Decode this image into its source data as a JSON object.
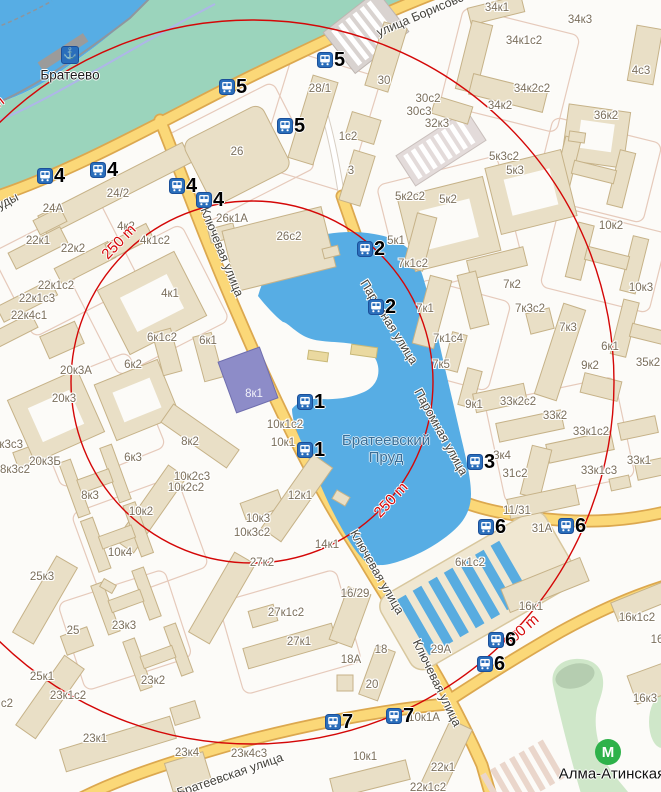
{
  "map": {
    "district_label": "Братеево",
    "pond_label": "Братеевский Пруд",
    "metro": {
      "name": "Алма-Атинская",
      "icon_x": 608,
      "icon_y": 752,
      "label_x": 612,
      "label_y": 774
    },
    "pier": {
      "x": 61,
      "y": 46
    },
    "colors": {
      "water": "#57ade4",
      "park": "#9bd4bc",
      "walkway": "#cfe7c9",
      "road_fill": "#fbd878",
      "road_casing": "#dca84f",
      "ring_red": "#d40707",
      "metro_green": "#2eb24a",
      "bus_blue": "#2a6ebb",
      "building": "#e9dfc6",
      "building_stroke": "#c6b288",
      "purple_building": "#8d8cc8"
    },
    "street_labels": [
      {
        "t": "улица Борисовские Пруды",
        "x": 448,
        "y": 3,
        "rot": -23
      },
      {
        "t": "улица Борисовские Пруды",
        "x": -51,
        "y": 231,
        "rot": -27
      },
      {
        "t": "Ключевая улица",
        "x": 222,
        "y": 252,
        "rot": 68
      },
      {
        "t": "Ключевая улица",
        "x": 377,
        "y": 572,
        "rot": 60
      },
      {
        "t": "Ключевая улица",
        "x": 437,
        "y": 683,
        "rot": 64
      },
      {
        "t": "Паромная улица",
        "x": 389,
        "y": 322,
        "rot": 58
      },
      {
        "t": "Паромная улица",
        "x": 441,
        "y": 432,
        "rot": 61
      },
      {
        "t": "Братеевская улица",
        "x": 230,
        "y": 775,
        "rot": -19
      }
    ],
    "distance_labels": [
      {
        "t": "250 m",
        "x": 119,
        "y": 242,
        "rot": -46
      },
      {
        "t": "250 m",
        "x": 391,
        "y": 500,
        "rot": -47
      },
      {
        "t": "600 m",
        "x": 521,
        "y": 631,
        "rot": -41
      },
      {
        "t": "600 m",
        "x": -14,
        "y": 112,
        "rot": -38
      }
    ],
    "bus_stops": [
      {
        "n": "4",
        "x": 37,
        "y": 168
      },
      {
        "n": "4",
        "x": 90,
        "y": 162
      },
      {
        "n": "4",
        "x": 169,
        "y": 178
      },
      {
        "n": "4",
        "x": 196,
        "y": 192
      },
      {
        "n": "5",
        "x": 219,
        "y": 79
      },
      {
        "n": "5",
        "x": 317,
        "y": 52
      },
      {
        "n": "5",
        "x": 277,
        "y": 118
      },
      {
        "n": "2",
        "x": 357,
        "y": 241
      },
      {
        "n": "2",
        "x": 368,
        "y": 299
      },
      {
        "n": "1",
        "x": 297,
        "y": 394
      },
      {
        "n": "1",
        "x": 297,
        "y": 442
      },
      {
        "n": "3",
        "x": 467,
        "y": 454
      },
      {
        "n": "6",
        "x": 478,
        "y": 519
      },
      {
        "n": "6",
        "x": 558,
        "y": 518
      },
      {
        "n": "6",
        "x": 488,
        "y": 632
      },
      {
        "n": "6",
        "x": 477,
        "y": 656
      },
      {
        "n": "7",
        "x": 325,
        "y": 714
      },
      {
        "n": "7",
        "x": 386,
        "y": 708
      }
    ],
    "building_labels": [
      {
        "t": "24А",
        "x": 53,
        "y": 209
      },
      {
        "t": "24/2",
        "x": 118,
        "y": 194
      },
      {
        "t": "22к1",
        "x": 38,
        "y": 241
      },
      {
        "t": "22к2",
        "x": 73,
        "y": 249
      },
      {
        "t": "4к2",
        "x": 126,
        "y": 227
      },
      {
        "t": "4к1с2",
        "x": 155,
        "y": 241
      },
      {
        "t": "4к1",
        "x": 170,
        "y": 294
      },
      {
        "t": "22к1с2",
        "x": 56,
        "y": 286
      },
      {
        "t": "22к1с3",
        "x": 37,
        "y": 299
      },
      {
        "t": "22к4с1",
        "x": 29,
        "y": 316
      },
      {
        "t": "26",
        "x": 237,
        "y": 152
      },
      {
        "t": "26к1А",
        "x": 232,
        "y": 219
      },
      {
        "t": "26с2",
        "x": 289,
        "y": 237
      },
      {
        "t": "28/1",
        "x": 320,
        "y": 89
      },
      {
        "t": "30",
        "x": 384,
        "y": 81
      },
      {
        "t": "30с2",
        "x": 428,
        "y": 99
      },
      {
        "t": "30с3",
        "x": 419,
        "y": 112
      },
      {
        "t": "32к3",
        "x": 437,
        "y": 124
      },
      {
        "t": "1с2",
        "x": 348,
        "y": 137
      },
      {
        "t": "3",
        "x": 351,
        "y": 171
      },
      {
        "t": "34к1",
        "x": 497,
        "y": 8
      },
      {
        "t": "34к3",
        "x": 580,
        "y": 20
      },
      {
        "t": "34к1с2",
        "x": 524,
        "y": 41
      },
      {
        "t": "34к2с2",
        "x": 532,
        "y": 89
      },
      {
        "t": "34к2",
        "x": 500,
        "y": 106
      },
      {
        "t": "36к2",
        "x": 606,
        "y": 116
      },
      {
        "t": "4с3",
        "x": 641,
        "y": 71
      },
      {
        "t": "10к2",
        "x": 611,
        "y": 226
      },
      {
        "t": "10к3",
        "x": 641,
        "y": 288
      },
      {
        "t": "5к2с2",
        "x": 410,
        "y": 197
      },
      {
        "t": "5к2",
        "x": 448,
        "y": 200
      },
      {
        "t": "5к3с2",
        "x": 504,
        "y": 157
      },
      {
        "t": "5к3",
        "x": 515,
        "y": 171
      },
      {
        "t": "5к1",
        "x": 396,
        "y": 241
      },
      {
        "t": "7к1с2",
        "x": 413,
        "y": 264
      },
      {
        "t": "7к1",
        "x": 425,
        "y": 309
      },
      {
        "t": "7к2",
        "x": 512,
        "y": 285
      },
      {
        "t": "7к3с2",
        "x": 530,
        "y": 309
      },
      {
        "t": "7к3",
        "x": 568,
        "y": 328
      },
      {
        "t": "7к1с4",
        "x": 448,
        "y": 339
      },
      {
        "t": "7к5",
        "x": 441,
        "y": 365
      },
      {
        "t": "9к2",
        "x": 590,
        "y": 366
      },
      {
        "t": "35к2",
        "x": 648,
        "y": 363
      },
      {
        "t": "9к1",
        "x": 474,
        "y": 405
      },
      {
        "t": "33к2с2",
        "x": 518,
        "y": 402
      },
      {
        "t": "33к2",
        "x": 555,
        "y": 416
      },
      {
        "t": "33к1с2",
        "x": 591,
        "y": 432
      },
      {
        "t": "33к1с3",
        "x": 599,
        "y": 471
      },
      {
        "t": "33к1",
        "x": 639,
        "y": 461
      },
      {
        "t": "31с2",
        "x": 515,
        "y": 474
      },
      {
        "t": "11/31",
        "x": 517,
        "y": 511
      },
      {
        "t": "31А",
        "x": 542,
        "y": 529
      },
      {
        "t": "3к4",
        "x": 502,
        "y": 456
      },
      {
        "t": "20к3А",
        "x": 76,
        "y": 371
      },
      {
        "t": "20к3",
        "x": 64,
        "y": 399
      },
      {
        "t": "20к3Б",
        "x": 45,
        "y": 462
      },
      {
        "t": "8к3с3",
        "x": 8,
        "y": 445
      },
      {
        "t": "8к3с2",
        "x": 15,
        "y": 470
      },
      {
        "t": "8к3",
        "x": 90,
        "y": 496
      },
      {
        "t": "6к1с2",
        "x": 162,
        "y": 338
      },
      {
        "t": "6к1",
        "x": 208,
        "y": 341
      },
      {
        "t": "6к2",
        "x": 133,
        "y": 365
      },
      {
        "t": "6к3",
        "x": 133,
        "y": 458
      },
      {
        "t": "8к2",
        "x": 190,
        "y": 442
      },
      {
        "t": "10к2с3",
        "x": 192,
        "y": 477
      },
      {
        "t": "10к2с2",
        "x": 186,
        "y": 488
      },
      {
        "t": "10к2",
        "x": 141,
        "y": 512
      },
      {
        "t": "10к3",
        "x": 258,
        "y": 519
      },
      {
        "t": "10к3с2",
        "x": 252,
        "y": 533
      },
      {
        "t": "10к1с2",
        "x": 285,
        "y": 425
      },
      {
        "t": "10к1",
        "x": 283,
        "y": 443
      },
      {
        "t": "12к1",
        "x": 300,
        "y": 496
      },
      {
        "t": "14к1",
        "x": 327,
        "y": 545
      },
      {
        "t": "10к4",
        "x": 120,
        "y": 553
      },
      {
        "t": "8к1",
        "x": 254,
        "y": 394,
        "light": true
      },
      {
        "t": "6к1с2",
        "x": 470,
        "y": 563
      },
      {
        "t": "6к1",
        "x": 610,
        "y": 347
      },
      {
        "t": "25к3",
        "x": 42,
        "y": 577
      },
      {
        "t": "25",
        "x": 73,
        "y": 631
      },
      {
        "t": "25к1",
        "x": 42,
        "y": 677
      },
      {
        "t": "23к1с2",
        "x": 68,
        "y": 696
      },
      {
        "t": "23к3",
        "x": 124,
        "y": 626
      },
      {
        "t": "23к2",
        "x": 153,
        "y": 681
      },
      {
        "t": "23к1",
        "x": 95,
        "y": 739
      },
      {
        "t": "23к4",
        "x": 187,
        "y": 753
      },
      {
        "t": "23к4с3",
        "x": 249,
        "y": 754
      },
      {
        "t": "27к2",
        "x": 262,
        "y": 563
      },
      {
        "t": "27к1с2",
        "x": 286,
        "y": 613
      },
      {
        "t": "27к1",
        "x": 299,
        "y": 642
      },
      {
        "t": "16/29",
        "x": 355,
        "y": 594
      },
      {
        "t": "18",
        "x": 381,
        "y": 650
      },
      {
        "t": "18А",
        "x": 351,
        "y": 660
      },
      {
        "t": "20",
        "x": 372,
        "y": 685
      },
      {
        "t": "29А",
        "x": 441,
        "y": 650
      },
      {
        "t": "10к1",
        "x": 365,
        "y": 757
      },
      {
        "t": "10к1А",
        "x": 424,
        "y": 718
      },
      {
        "t": "22к1",
        "x": 443,
        "y": 768
      },
      {
        "t": "22к1с2",
        "x": 428,
        "y": 788
      },
      {
        "t": "16к1",
        "x": 531,
        "y": 607
      },
      {
        "t": "16к1с2",
        "x": 637,
        "y": 618
      },
      {
        "t": "16",
        "x": 657,
        "y": 640
      },
      {
        "t": "16к3",
        "x": 645,
        "y": 699
      },
      {
        "t": "с2",
        "x": 7,
        "y": 704
      }
    ]
  }
}
